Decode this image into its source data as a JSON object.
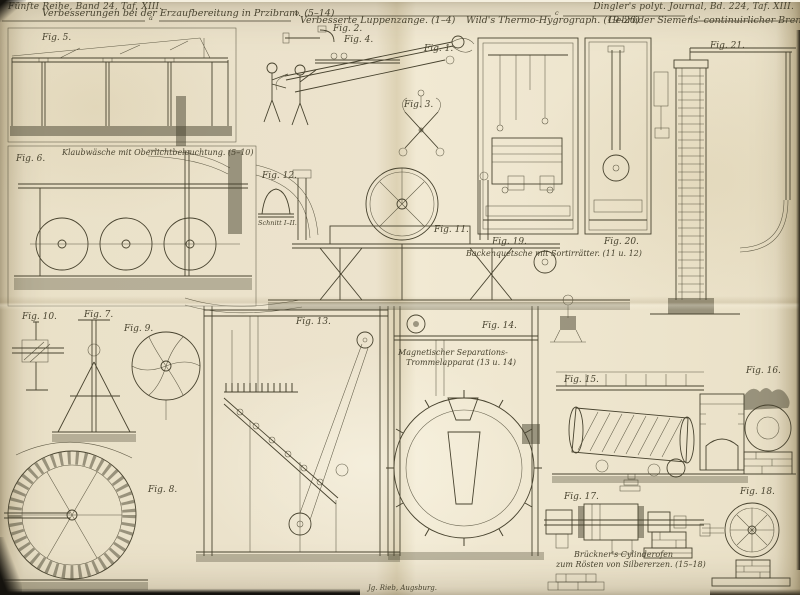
{
  "colors": {
    "paper": "#eae1c8",
    "ink": "#48432f",
    "edge": "#8a7b57"
  },
  "plate": {
    "series_ref": "Fünfte Reihe, Band 24, Taf. XIII.",
    "journal_ref": "Dingler's polyt. Journal, Bd. 224, Taf. XIII.",
    "printer_mark": "Jg. Rieb, Augsburg.",
    "markers": [
      "a",
      "b",
      "c",
      "d"
    ]
  },
  "sections": [
    {
      "title": "Verbesserungen bei der Erzaufbereitung in Przibram. (5–14)"
    },
    {
      "title": "Verbesserte Luppenzange. (1–4)"
    },
    {
      "title": "Wild's Thermo-Hygrograph. (19–20)"
    },
    {
      "title": "Gebrüder Siemens' continuirlicher Brennapparat. (21)"
    }
  ],
  "captions": {
    "klaubwaesche": "Klaubwäsche mit Oberlichtbeleuchtung. (5–10)",
    "backenquetsche": "Backenquetsche mit Sortirrätter. (11 u. 12)",
    "separator1": "Magnetischer Separations-",
    "separator2": "Trommelapparat (13 u. 14)",
    "schnitt": "Schnitt I–II.",
    "brueckner1": "Brückner's Cylinderofen",
    "brueckner2": "zum Rösten von Silbererzen. (15–18)"
  },
  "figures": [
    {
      "label": "Fig. 1."
    },
    {
      "label": "Fig. 2."
    },
    {
      "label": "Fig. 3."
    },
    {
      "label": "Fig. 4."
    },
    {
      "label": "Fig. 5."
    },
    {
      "label": "Fig. 6."
    },
    {
      "label": "Fig. 7."
    },
    {
      "label": "Fig. 8."
    },
    {
      "label": "Fig. 9."
    },
    {
      "label": "Fig. 10."
    },
    {
      "label": "Fig. 11."
    },
    {
      "label": "Fig. 12."
    },
    {
      "label": "Fig. 13."
    },
    {
      "label": "Fig. 14."
    },
    {
      "label": "Fig. 15."
    },
    {
      "label": "Fig. 16."
    },
    {
      "label": "Fig. 17."
    },
    {
      "label": "Fig. 18."
    },
    {
      "label": "Fig. 19."
    },
    {
      "label": "Fig. 20."
    },
    {
      "label": "Fig. 21."
    }
  ]
}
